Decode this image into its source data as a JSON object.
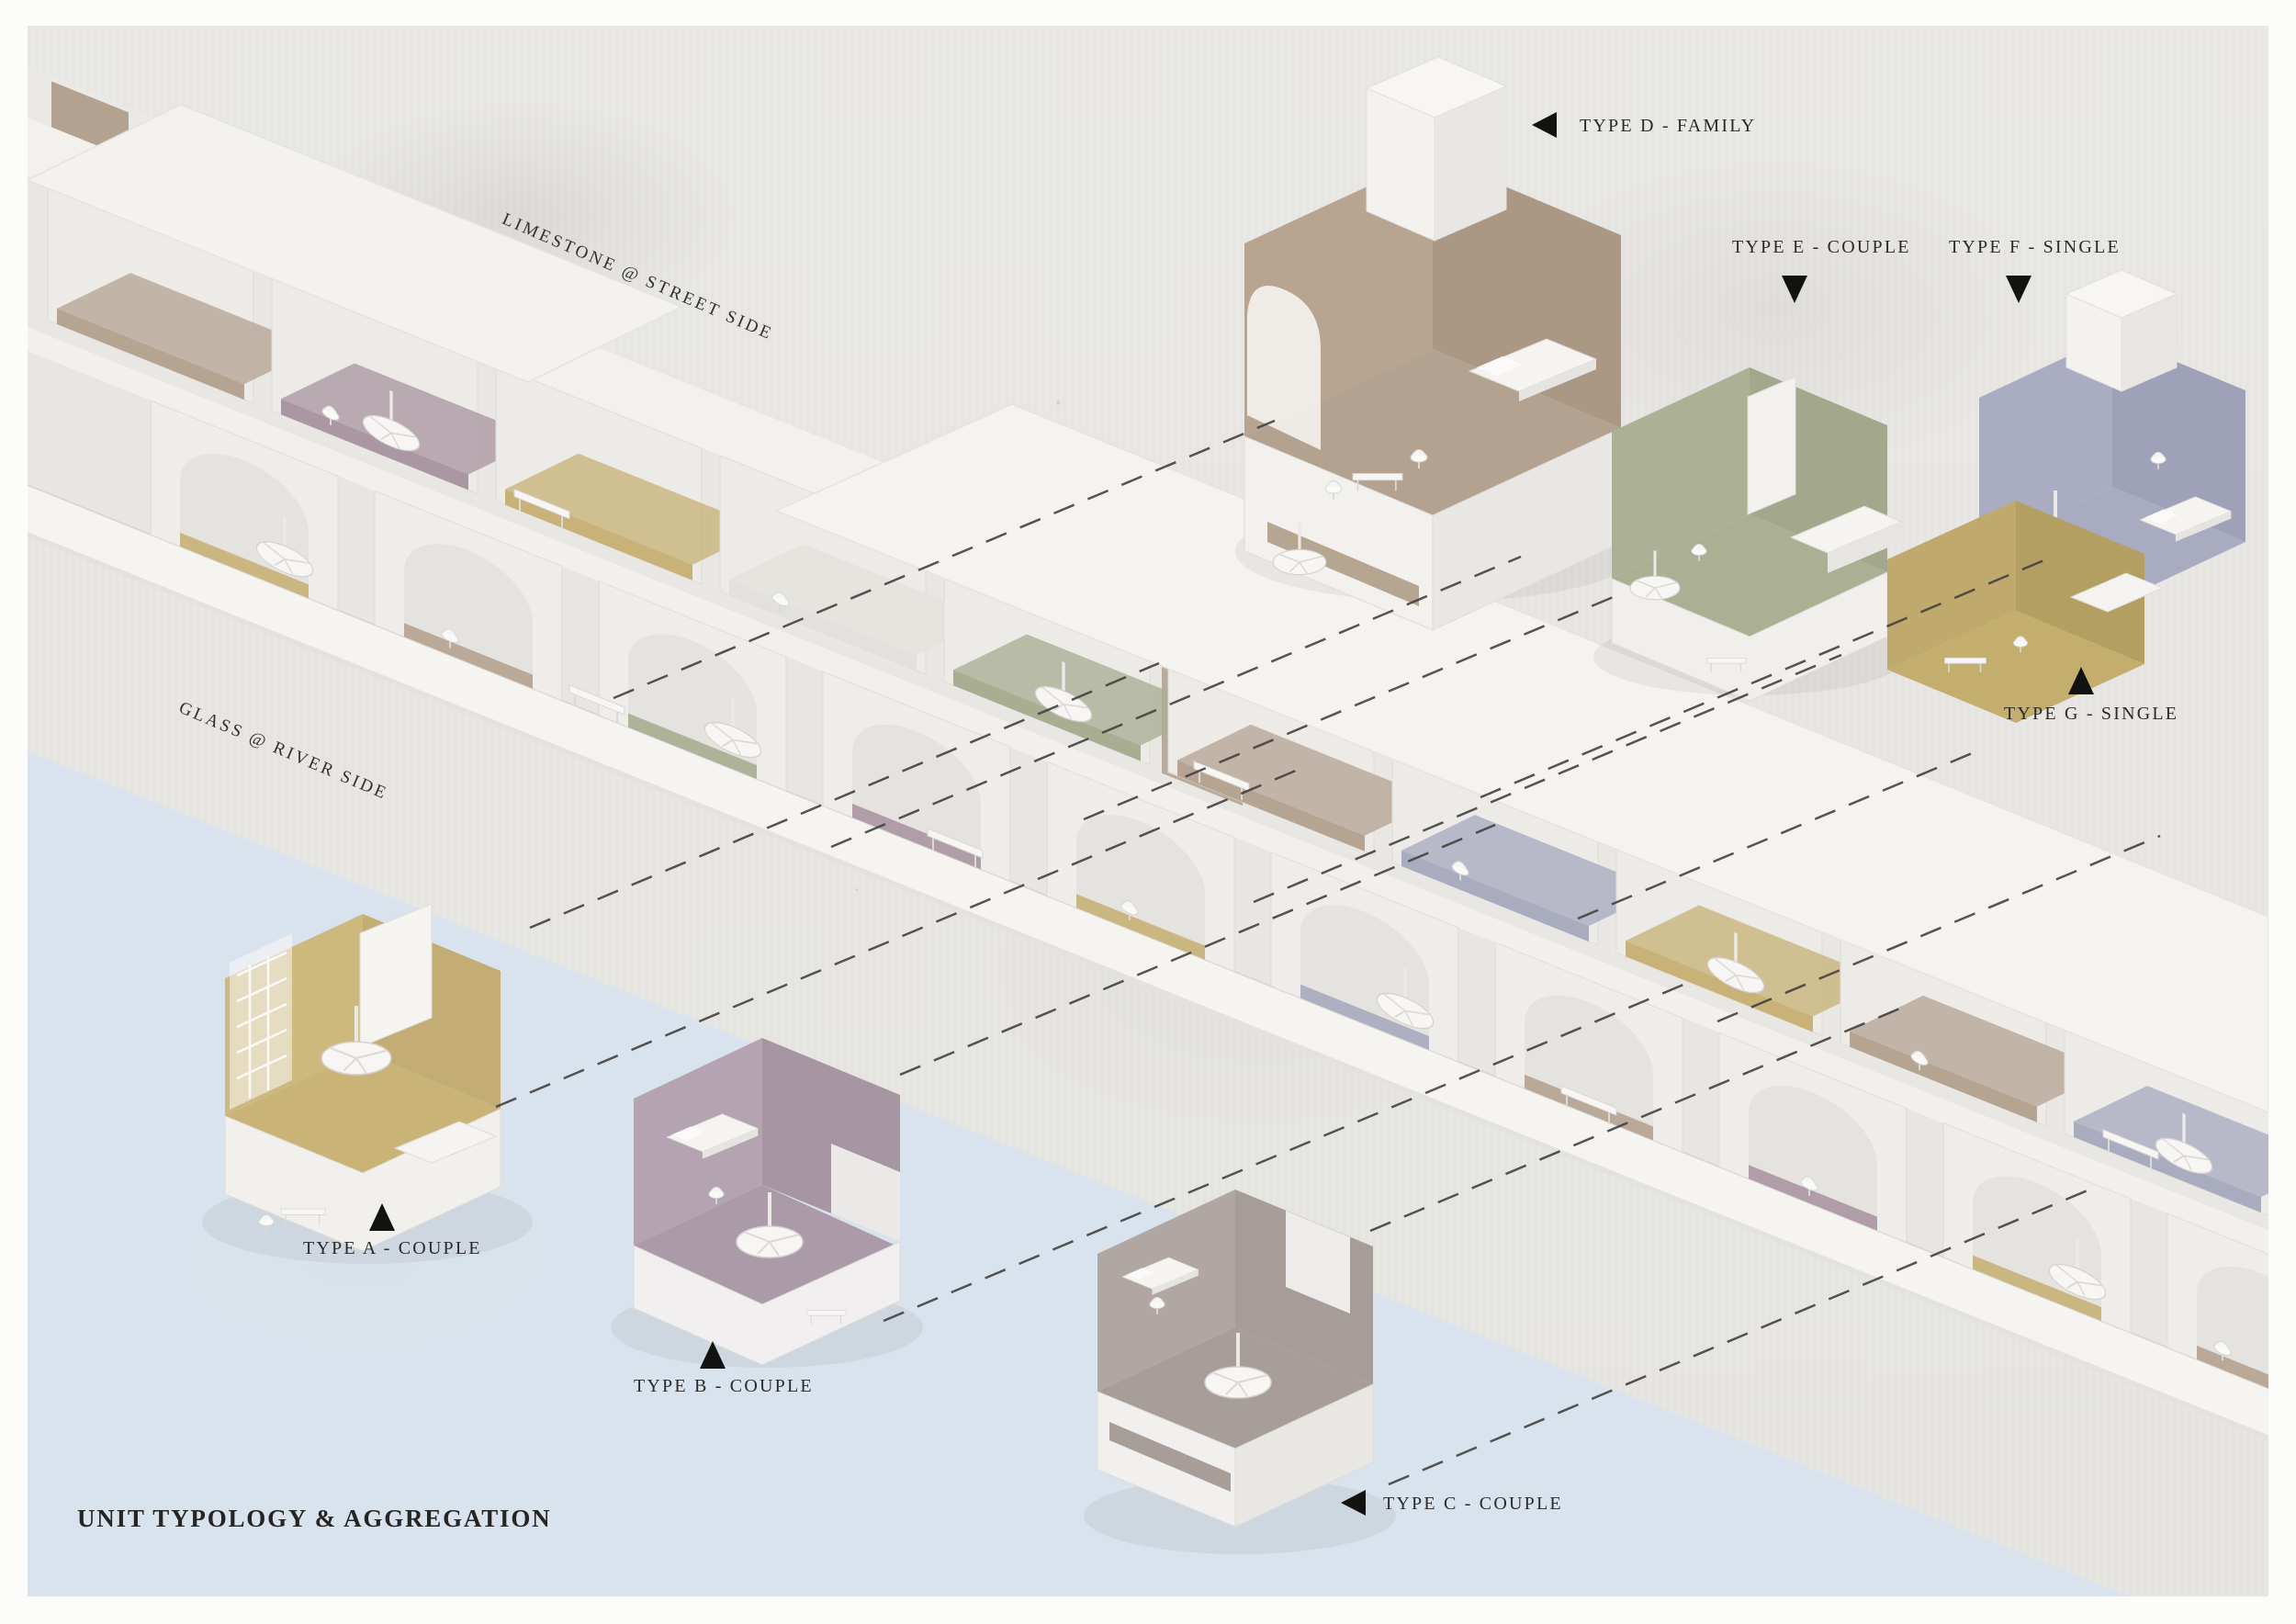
{
  "page": {
    "title": "UNIT TYPOLOGY & AGGREGATION"
  },
  "annotations": {
    "street_side": "LIMESTONE @ STREET SIDE",
    "river_side": "GLASS @ RIVER SIDE"
  },
  "legend": {
    "units": [
      {
        "type": "A",
        "label": "TYPE A - COUPLE",
        "occupancy": "COUPLE",
        "arrow": "up",
        "accent": "#c9b377"
      },
      {
        "type": "B",
        "label": "TYPE B - COUPLE",
        "occupancy": "COUPLE",
        "arrow": "up",
        "accent": "#b2a2af"
      },
      {
        "type": "C",
        "label": "TYPE C - COUPLE",
        "occupancy": "COUPLE",
        "arrow": "left",
        "accent": "#aba19c"
      },
      {
        "type": "D",
        "label": "TYPE D - FAMILY",
        "occupancy": "FAMILY",
        "arrow": "left",
        "accent": "#b5a28e"
      },
      {
        "type": "E",
        "label": "TYPE E - COUPLE",
        "occupancy": "COUPLE",
        "arrow": "down",
        "accent": "#abb095"
      },
      {
        "type": "F",
        "label": "TYPE F - SINGLE",
        "occupancy": "SINGLE",
        "arrow": "down",
        "accent": "#a9abc0"
      },
      {
        "type": "G",
        "label": "TYPE G - SINGLE",
        "occupancy": "SINGLE",
        "arrow": "up",
        "accent": "#c4ae6e"
      }
    ]
  },
  "palette": {
    "background_concrete": "#e8e7e4",
    "water": "#d8e3ee",
    "white_wall": "#efedea",
    "roof": "#f3f2ef",
    "limestone": "#b3a28f",
    "taupe": "#b6a493",
    "mauve": "#ab97a3",
    "gold": "#c8b277",
    "sage": "#a9ae93",
    "lavender": "#a9abbf",
    "leader_line": "#44423f",
    "text": "#2b2a28"
  }
}
